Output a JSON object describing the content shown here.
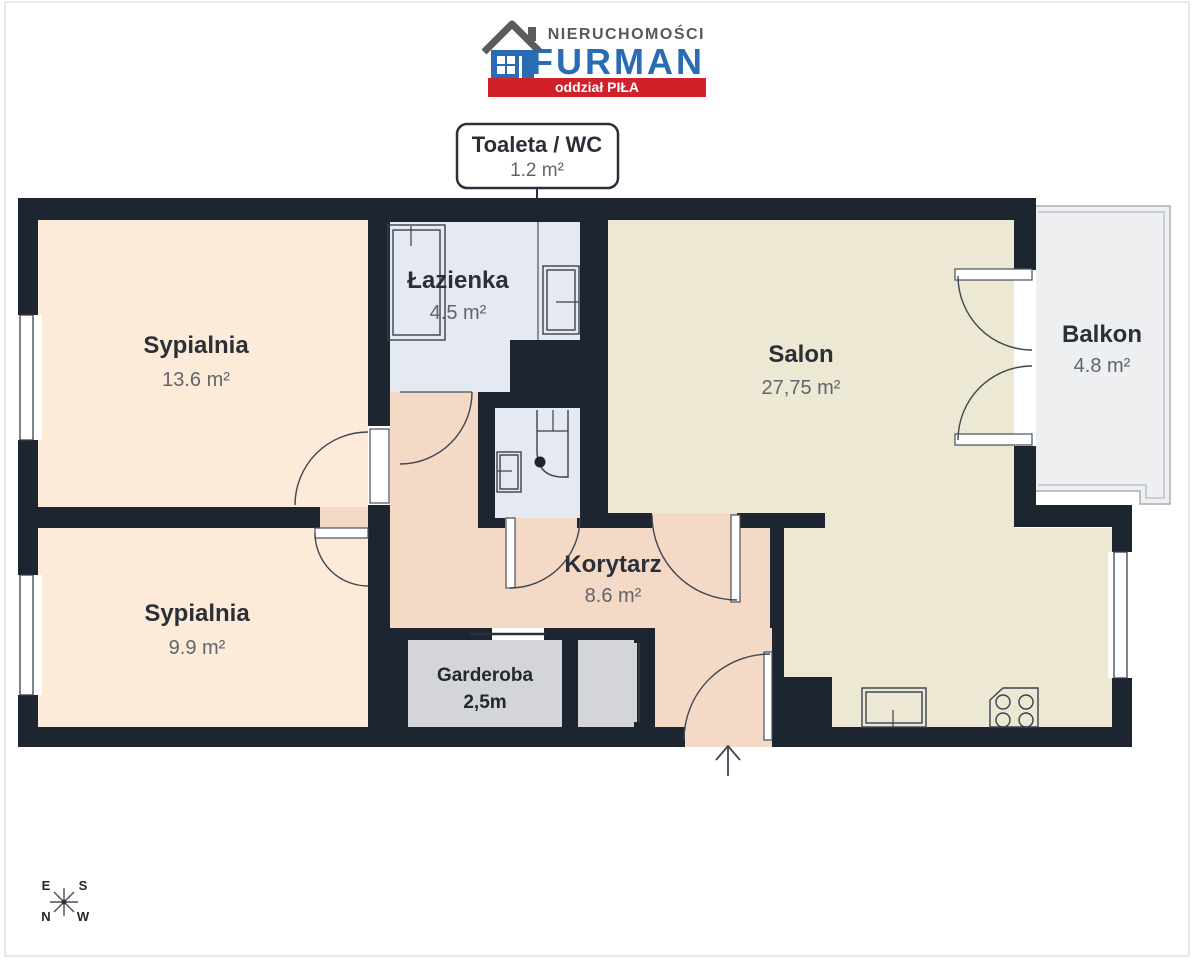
{
  "branding": {
    "line1": "NIERUCHOMOŚCI",
    "line2": "FURMAN",
    "branch": "oddział PIŁA"
  },
  "callout": {
    "title": "Toaleta / WC",
    "area": "1.2 m²"
  },
  "rooms": {
    "sypialnia1": {
      "name": "Sypialnia",
      "area": "13.6 m²"
    },
    "sypialnia2": {
      "name": "Sypialnia",
      "area": "9.9 m²"
    },
    "lazienka": {
      "name": "Łazienka",
      "area": "4.5 m²"
    },
    "salon": {
      "name": "Salon",
      "area": "27,75 m²"
    },
    "balkon": {
      "name": "Balkon",
      "area": "4.8 m²"
    },
    "korytarz": {
      "name": "Korytarz",
      "area": "8.6 m²"
    },
    "garderoba": {
      "name": "Garderoba",
      "area": "2,5m"
    }
  },
  "compass": {
    "top_left": "E",
    "top_right": "S",
    "bottom_left": "N",
    "bottom_right": "W"
  },
  "colors": {
    "wall": "#1d2531",
    "bedroom_fill": "#fcebd8",
    "corridor_fill": "#f4d9c7",
    "salon_fill": "#ede8d3",
    "bathroom_fill": "#e4e9f2",
    "closet_fill": "#d4d5d8",
    "balcony_fill": "#edeff1",
    "brand_blue": "#2a6cb4",
    "brand_red": "#d0202a",
    "brand_gray": "#58595b"
  }
}
